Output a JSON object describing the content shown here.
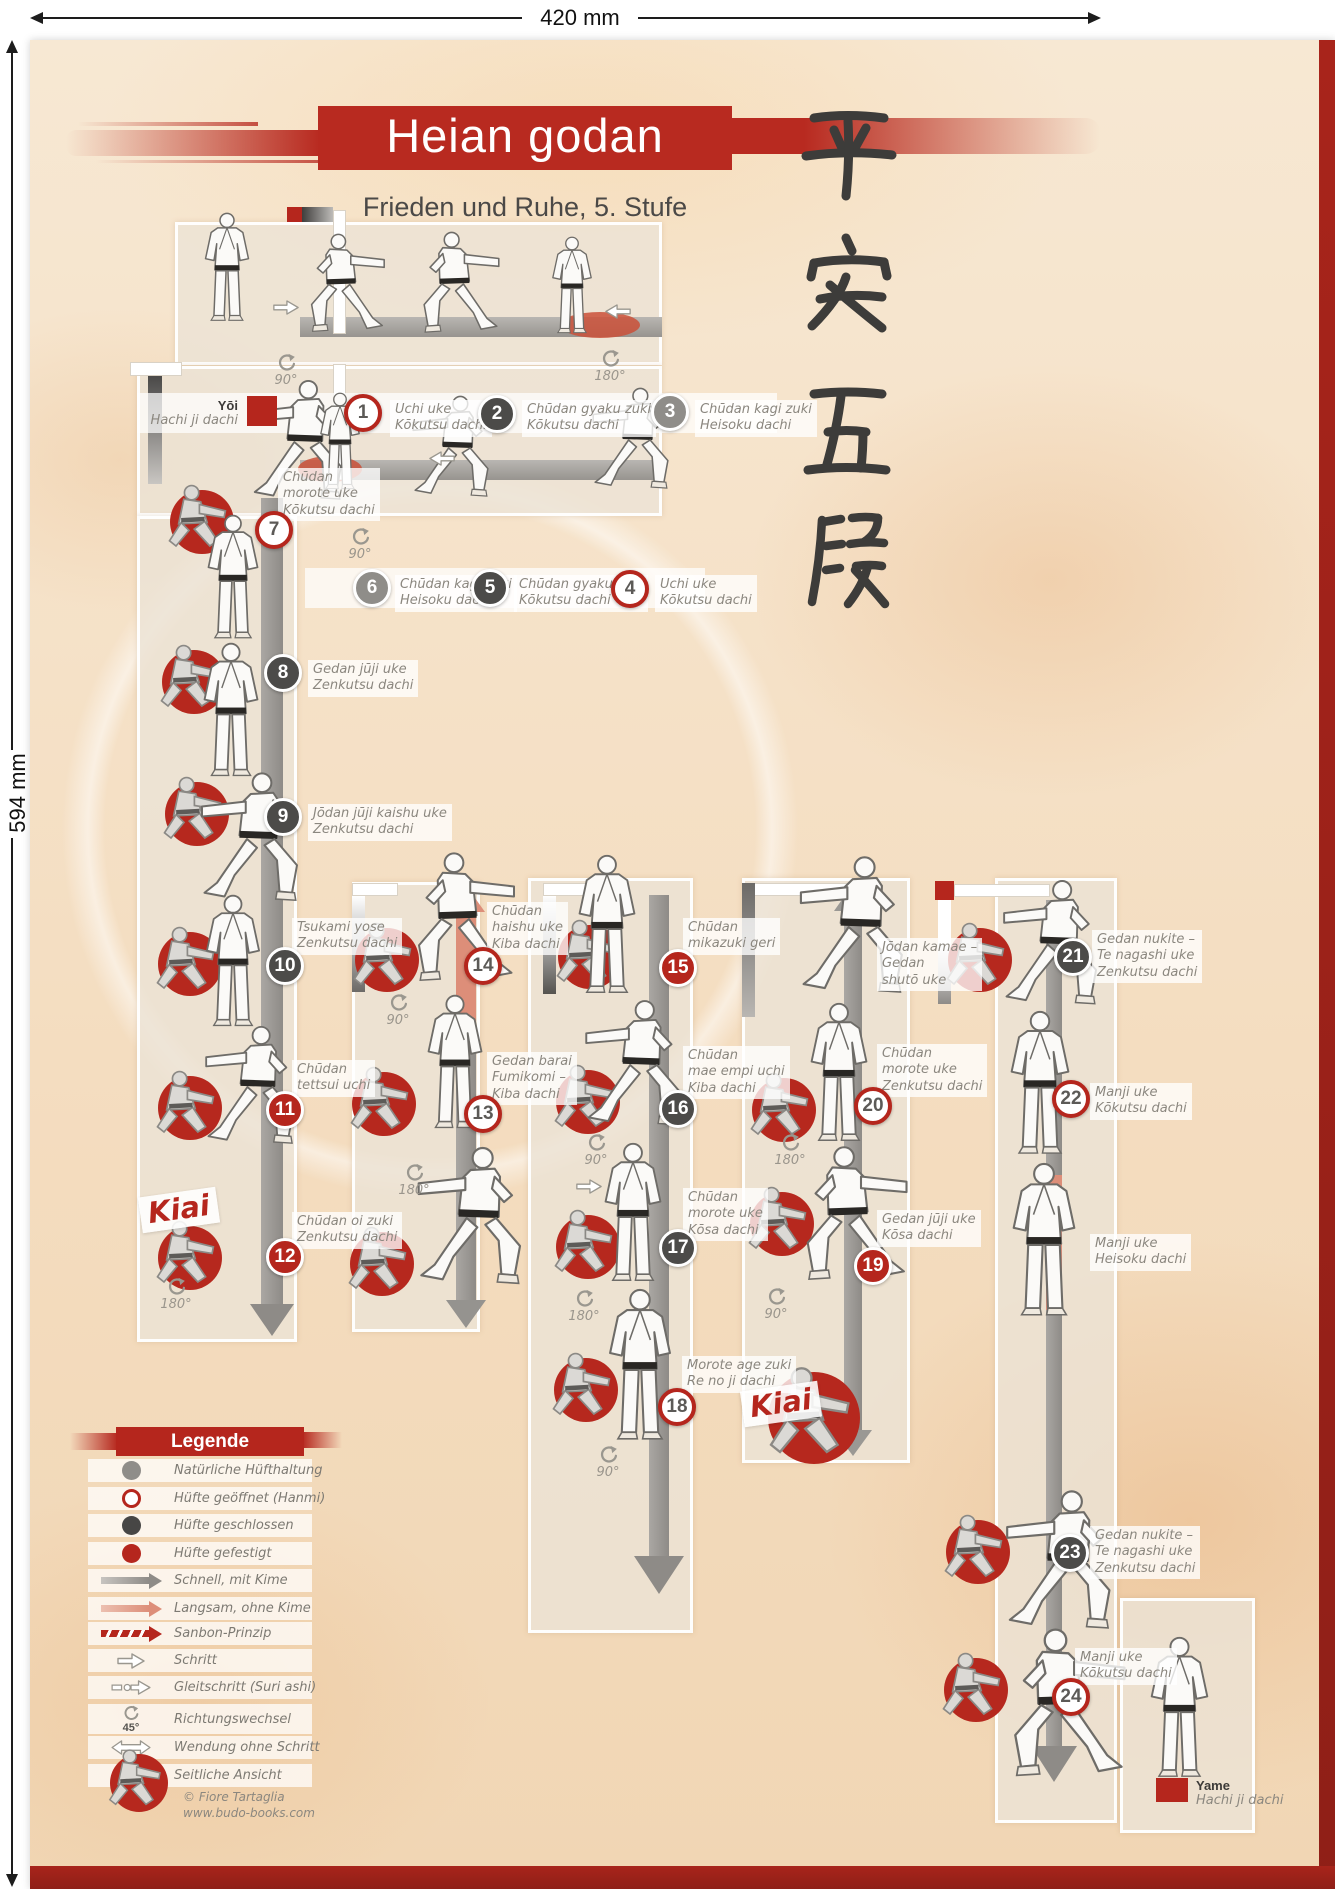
{
  "dimensions": {
    "width": "420 mm",
    "height": "594 mm"
  },
  "header": {
    "title": "Heian godan",
    "subtitle": "Frieden und Ruhe, 5. Stufe",
    "calligraphy": "平安五段"
  },
  "yoi": {
    "name": "Yōi",
    "stance": "Hachi ji dachi"
  },
  "yame": {
    "name": "Yame",
    "stance": "Hachi ji dachi"
  },
  "kiai_label": "Kiai",
  "colors": {
    "accent_red": "#b5261d",
    "dark": "#4c4b49",
    "gray": "#8f8d89",
    "salmon": "#dd8e79"
  },
  "steps": [
    {
      "num": "1",
      "hip": "geöffnet",
      "lines": [
        "Uchi uke",
        "Kōkutsu dachi"
      ]
    },
    {
      "num": "2",
      "hip": "geschlossen",
      "lines": [
        "Chūdan gyaku zuki",
        "Kōkutsu dachi"
      ]
    },
    {
      "num": "3",
      "hip": "natürlich",
      "lines": [
        "Chūdan kagi zuki",
        "Heisoku dachi"
      ]
    },
    {
      "num": "4",
      "hip": "geöffnet",
      "lines": [
        "Uchi uke",
        "Kōkutsu dachi"
      ]
    },
    {
      "num": "5",
      "hip": "geschlossen",
      "lines": [
        "Chūdan gyaku zuki",
        "Kōkutsu dachi"
      ]
    },
    {
      "num": "6",
      "hip": "natürlich",
      "lines": [
        "Chūdan kagi zuki",
        "Heisoku dachi"
      ]
    },
    {
      "num": "7",
      "hip": "geöffnet",
      "lines": [
        "Chūdan",
        "morote uke",
        "Kōkutsu dachi"
      ]
    },
    {
      "num": "8",
      "hip": "geschlossen",
      "lines": [
        "Gedan jūji uke",
        "Zenkutsu dachi"
      ]
    },
    {
      "num": "9",
      "hip": "geschlossen",
      "lines": [
        "Jōdan jūji kaishu uke",
        "Zenkutsu dachi"
      ]
    },
    {
      "num": "10",
      "hip": "geschlossen",
      "lines": [
        "Tsukami yose",
        "Zenkutsu dachi"
      ]
    },
    {
      "num": "11",
      "hip": "gefestigt",
      "lines": [
        "Chūdan",
        "tettsui uchi"
      ]
    },
    {
      "num": "12",
      "hip": "gefestigt",
      "lines": [
        "Chūdan oi zuki",
        "Zenkutsu dachi"
      ]
    },
    {
      "num": "13",
      "hip": "geöffnet",
      "lines": [
        "Gedan barai",
        "Fumikomi –",
        "Kiba dachi"
      ]
    },
    {
      "num": "14",
      "hip": "geöffnet",
      "lines": [
        "Chūdan",
        "haishu uke",
        "Kiba dachi"
      ]
    },
    {
      "num": "15",
      "hip": "gefestigt",
      "lines": [
        "Chūdan",
        "mikazuki geri"
      ]
    },
    {
      "num": "16",
      "hip": "geschlossen",
      "lines": [
        "Chūdan",
        "mae empi uchi",
        "Kiba dachi"
      ]
    },
    {
      "num": "17",
      "hip": "geschlossen",
      "lines": [
        "Chūdan",
        "morote uke",
        "Kōsa dachi"
      ]
    },
    {
      "num": "18",
      "hip": "geöffnet",
      "lines": [
        "Morote age zuki",
        "Re no ji dachi"
      ]
    },
    {
      "num": "19",
      "hip": "gefestigt",
      "lines": [
        "Gedan jūji uke",
        "Kōsa dachi"
      ]
    },
    {
      "num": "20",
      "hip": "geöffnet",
      "lines": [
        "Chūdan",
        "morote uke",
        "Zenkutsu dachi"
      ]
    },
    {
      "num": "21",
      "hip": "geschlossen",
      "lines": [
        "Gedan nukite –",
        "Te nagashi uke",
        "Zenkutsu dachi"
      ]
    },
    {
      "num": "22",
      "hip": "geöffnet",
      "lines": [
        "Manji uke",
        "Kōkutsu dachi"
      ]
    },
    {
      "num": "23",
      "hip": "geschlossen",
      "lines": [
        "Gedan nukite –",
        "Te nagashi uke",
        "Zenkutsu dachi"
      ]
    },
    {
      "num": "24",
      "hip": "geöffnet",
      "lines": [
        "Manji uke",
        "Kōkutsu dachi"
      ]
    }
  ],
  "notes": [
    {
      "lines": [
        "Jōdan kamae –",
        "Gedan",
        "shutō uke"
      ]
    },
    {
      "lines": [
        "Manji uke",
        "Heisoku dachi"
      ]
    }
  ],
  "rotations": [
    {
      "text": "90°"
    },
    {
      "text": "180°"
    },
    {
      "text": "90°"
    },
    {
      "text": "180°"
    },
    {
      "text": "90°"
    },
    {
      "text": "180°"
    },
    {
      "text": "90°"
    },
    {
      "text": "180°"
    },
    {
      "text": "90°"
    },
    {
      "text": "180°"
    },
    {
      "text": "90°"
    }
  ],
  "legend": {
    "title": "Legende",
    "items": [
      {
        "icon": "circle-gray",
        "label": "Natürliche Hüfthaltung"
      },
      {
        "icon": "circle-open-red",
        "label": "Hüfte geöffnet (Hanmi)"
      },
      {
        "icon": "circle-dark",
        "label": "Hüfte geschlossen"
      },
      {
        "icon": "circle-red",
        "label": "Hüfte gefestigt"
      },
      {
        "icon": "arrow-gray",
        "label": "Schnell, mit Kime"
      },
      {
        "icon": "arrow-salmon",
        "label": "Langsam, ohne Kime"
      },
      {
        "icon": "arrow-sanbon",
        "label": "Sanbon-Prinzip"
      },
      {
        "icon": "open-arrow",
        "label": "Schritt"
      },
      {
        "icon": "open-arrow-slide",
        "label": "Gleitschritt (Suri ashi)"
      },
      {
        "icon": "rotate",
        "label": "Richtungswechsel",
        "sub": "45°"
      },
      {
        "icon": "turn-arrow",
        "label": "Wendung ohne Schritt"
      },
      {
        "icon": "side-view",
        "label": "Seitliche Ansicht"
      }
    ],
    "credit1": "© Fiore Tartaglia",
    "credit2": "www.budo-books.com"
  }
}
